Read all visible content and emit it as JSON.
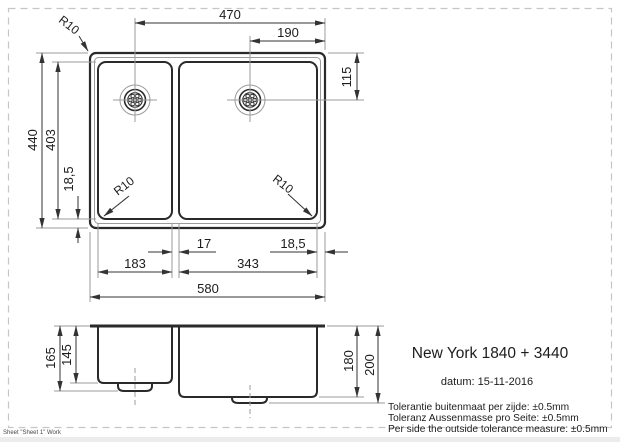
{
  "info": {
    "model": "New York 1840 + 3440",
    "date": "datum: 15-11-2016",
    "tolerance_nl": "Tolerantie buitenmaat per zijde: ±0.5mm",
    "tolerance_de": "Toleranz Aussenmasse pro Seite: ±0.5mm",
    "tolerance_en": "Per side the outside tolerance measure: ±0.5mm"
  },
  "footer": {
    "sheet_label": "Sheet \"Sheet 1\" Work"
  },
  "top_view": {
    "width_total": "580",
    "width_drain_to_right_edge": "470",
    "width_right_drain_to_edge": "190",
    "drain_depth_from_top": "115",
    "height_total": "440",
    "height_inner": "403",
    "edge_margin_left": "18,5",
    "bowl_gap": "17",
    "edge_margin_right": "18,5",
    "left_bowl_width": "183",
    "right_bowl_width": "343",
    "corner_radius": "R10",
    "left_bowl_radius": "R10",
    "right_bowl_radius": "R10"
  },
  "side_view": {
    "left_bowl_depth_outer": "165",
    "left_bowl_depth_inner": "145",
    "right_bowl_depth_inner": "180",
    "right_bowl_depth_outer": "200"
  },
  "colors": {
    "object_line": "#2a2a2a",
    "thin_line": "#9b9b9b",
    "text": "#1c1c1c",
    "border": "#c6c6c6"
  }
}
